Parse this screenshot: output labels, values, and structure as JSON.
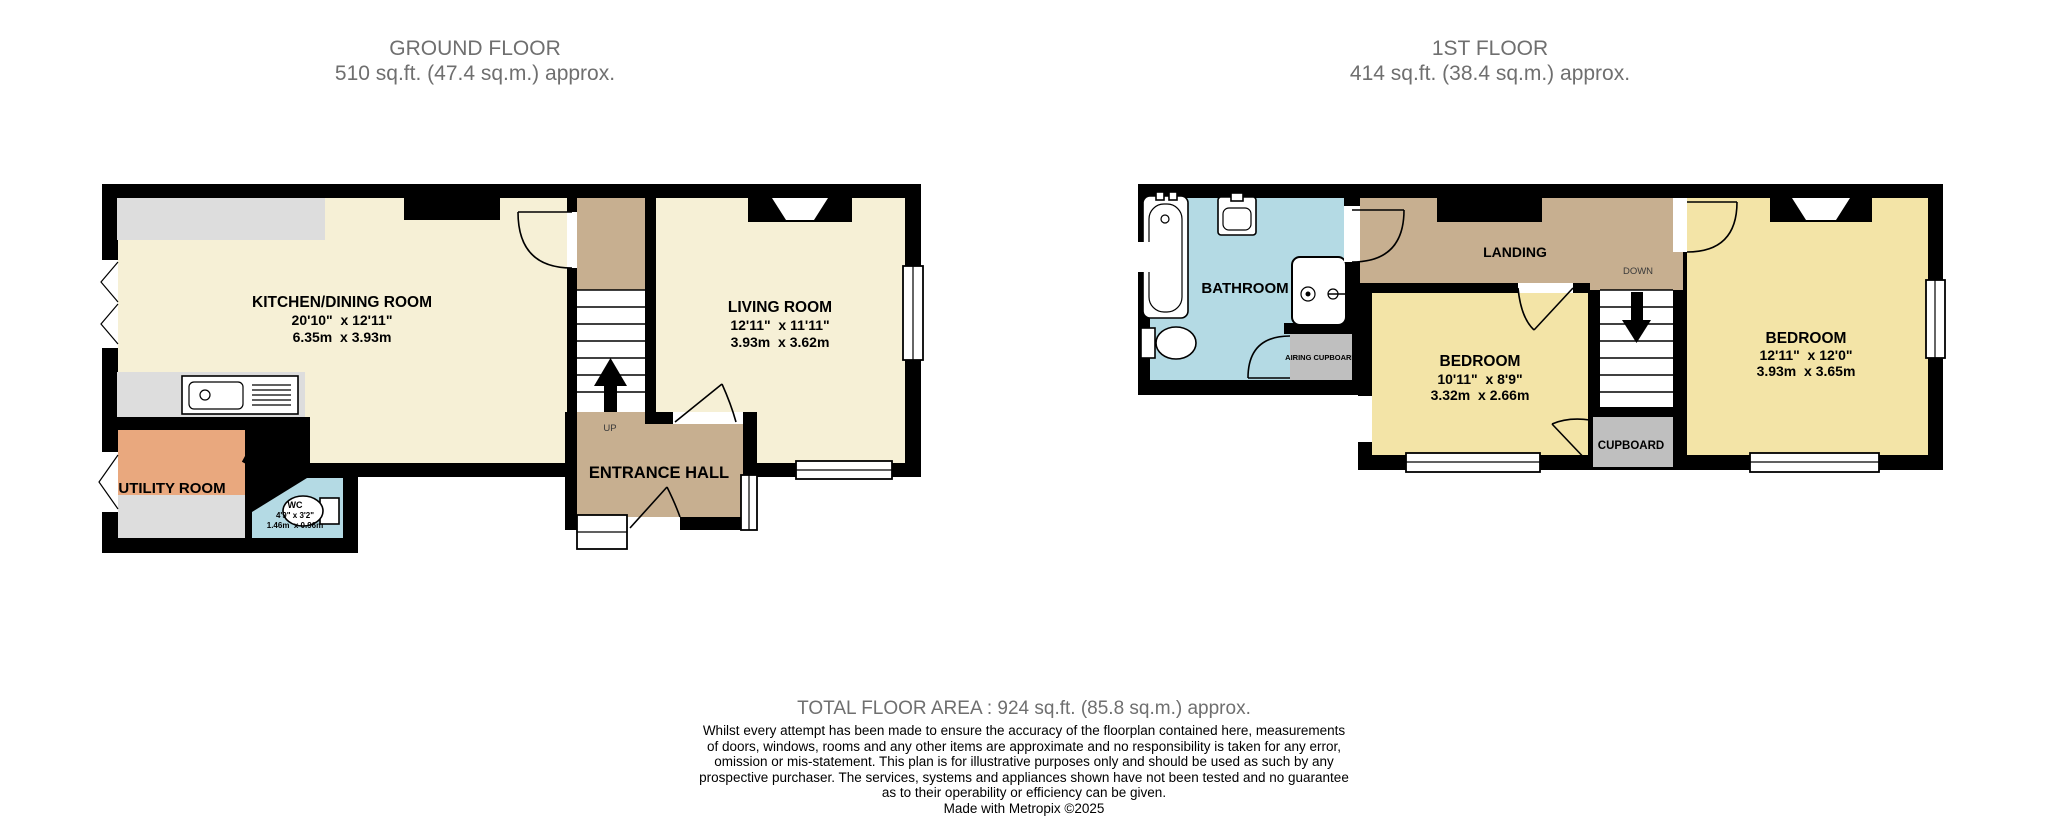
{
  "floors": [
    {
      "title": "GROUND FLOOR",
      "subtitle": "510 sq.ft. (47.4 sq.m.) approx."
    },
    {
      "title": "1ST FLOOR",
      "subtitle": "414 sq.ft. (38.4 sq.m.) approx."
    }
  ],
  "ground": {
    "kitchen": {
      "name": "KITCHEN/DINING ROOM",
      "imperial": "20'10\"  x 12'11\"",
      "metric": "6.35m  x 3.93m"
    },
    "living": {
      "name": "LIVING ROOM",
      "imperial": "12'11\"  x 11'11\"",
      "metric": "3.93m  x 3.62m"
    },
    "utility": {
      "name": "UTILITY ROOM"
    },
    "wc": {
      "name": "WC",
      "imperial": "4'9\" x 3'2\"",
      "metric": "1.46m  x 0.96m"
    },
    "entrance": {
      "name": "ENTRANCE HALL"
    },
    "stairs": {
      "label": "UP"
    }
  },
  "first": {
    "bathroom": {
      "name": "BATHROOM"
    },
    "landing": {
      "name": "LANDING"
    },
    "airing": {
      "name": "AIRING CUPBOARD"
    },
    "bedroom_left": {
      "name": "BEDROOM",
      "imperial": "10'11\"  x 8'9\"",
      "metric": "3.32m  x 2.66m"
    },
    "bedroom_right": {
      "name": "BEDROOM",
      "imperial": "12'11\"  x 12'0\"",
      "metric": "3.93m  x 3.65m"
    },
    "cupboard": {
      "name": "CUPBOARD"
    },
    "stairs": {
      "label": "DOWN"
    }
  },
  "footer": {
    "total": "TOTAL FLOOR AREA : 924 sq.ft. (85.8 sq.m.) approx.",
    "disclaimer_lines": [
      "Whilst every attempt has been made to ensure the accuracy of the floorplan contained here, measurements",
      "of doors, windows, rooms and any other items are approximate and no responsibility is taken for any error,",
      "omission or mis-statement. This plan is for illustrative purposes only and should be used as such by any",
      "prospective purchaser. The services, systems and appliances shown have not been tested and no guarantee",
      "as to their operability or efficiency can be given."
    ],
    "credit": "Made with Metropix ©2025"
  },
  "colors": {
    "wall": "#000000",
    "ground_room": "#F6F0D6",
    "first_room": "#F3E4A7",
    "hall_landing": "#C7AF90",
    "utility": "#E9A87E",
    "wet_room": "#B4DAE4",
    "cupboard": "#BFBFBF",
    "counter": "#DDDDDD",
    "title_text": "#6F6F6F"
  }
}
